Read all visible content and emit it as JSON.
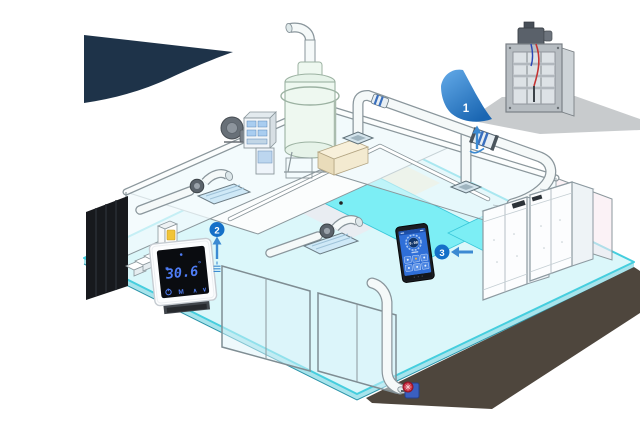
{
  "colors": {
    "accent_blue": "#1470c8",
    "arrow_blue": "#3c8ad2",
    "navy": "#1e3349",
    "pool_cyan": "#7ceef5",
    "floor_cyan": "#dbf7fa",
    "display_blue": "#4f7df5",
    "screen_blue": "#2f6fd8"
  },
  "callouts": {
    "one": {
      "label": "1"
    },
    "two": {
      "label": "2"
    },
    "three": {
      "label": "3"
    }
  },
  "thermostat": {
    "temperature": "30.6",
    "degree_symbol": "°",
    "mode_label": "M",
    "up_label": "∧",
    "down_label": "∨"
  },
  "controller": {
    "reading": "0.00"
  }
}
